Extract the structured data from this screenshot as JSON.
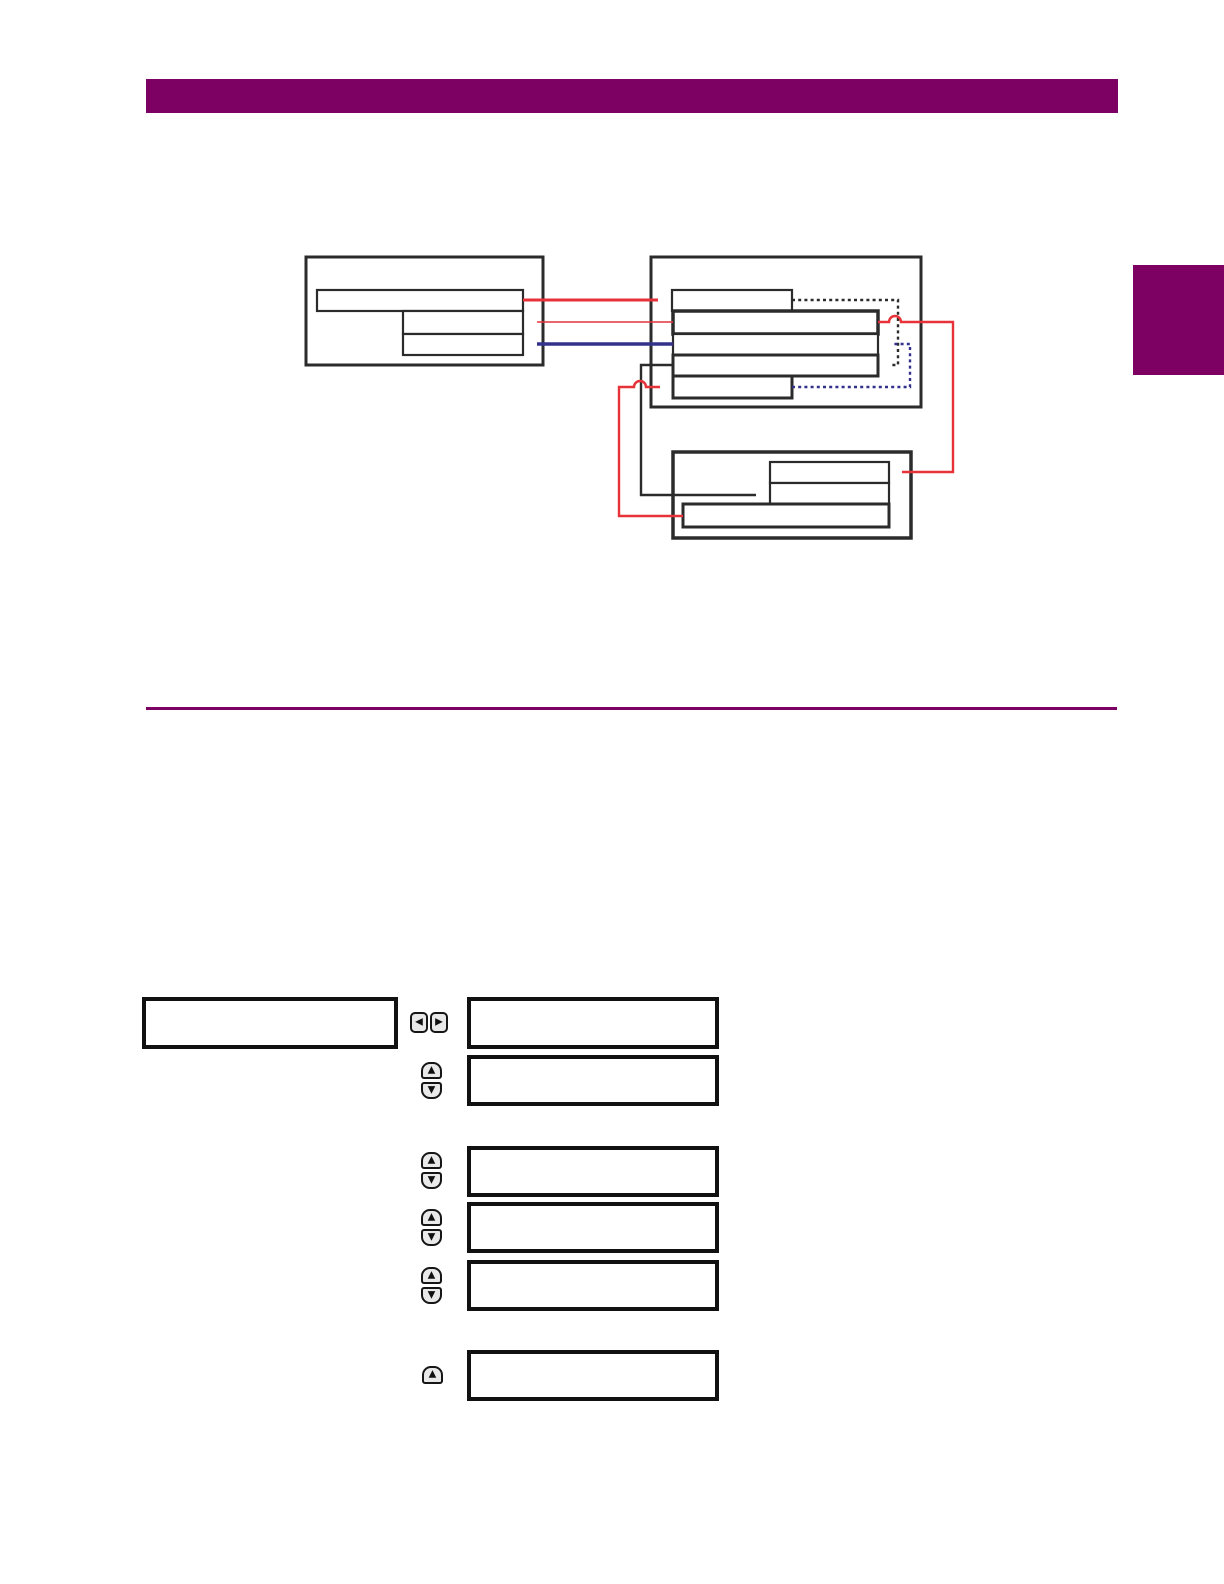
{
  "page": {
    "width_px": 1224,
    "height_px": 1584,
    "background": "#ffffff"
  },
  "theme": {
    "accent": "#7d0063",
    "line_black": "#2b2b2b",
    "line_red": "#e63238",
    "line_blue": "#32328c",
    "key_fill": "#e9e9e9",
    "key_border": "#161616",
    "lcd_border": "#111111"
  },
  "header": {
    "bar_color": "#7d0063",
    "text": ""
  },
  "side_tab": {
    "color": "#7d0063",
    "text": ""
  },
  "icons": {
    "left_arrow": "◀",
    "right_arrow": "▶",
    "up_arrow": "▲",
    "down_arrow": "▼"
  },
  "flow_diagram": {
    "left_group": {
      "rows": 3,
      "text": [
        "",
        "",
        ""
      ]
    },
    "right_group": {
      "rows": 5,
      "text": [
        "",
        "",
        "",
        "",
        ""
      ]
    },
    "bottom_group": {
      "rows": 3,
      "text": [
        "",
        "",
        ""
      ]
    },
    "arrows": [
      {
        "name": "red-solid-left-row1-to-right-row1",
        "color": "#e63238",
        "style": "solid"
      },
      {
        "name": "red-thin-right-row2-to-left-row2",
        "color": "#e63238",
        "style": "solid"
      },
      {
        "name": "blue-solid-right-row3-to-left-row3",
        "color": "#32328c",
        "style": "solid"
      },
      {
        "name": "black-dashed-right-row1-to-right-row4",
        "color": "#2b2b2b",
        "style": "dashed"
      },
      {
        "name": "blue-dashed-right-row5-to-right-row3",
        "color": "#32328c",
        "style": "dashed"
      },
      {
        "name": "red-route-right-row2-to-bottom-row1",
        "color": "#e63238",
        "style": "solid"
      },
      {
        "name": "black-route-right-row4-to-bottom-row2",
        "color": "#2b2b2b",
        "style": "solid"
      },
      {
        "name": "red-route-bottom-row3-to-right-row5",
        "color": "#e63238",
        "style": "solid"
      }
    ]
  },
  "keypad_figure": {
    "display_boxes": [
      {
        "id": "left-display",
        "text": ""
      },
      {
        "id": "right-display-1",
        "text": ""
      },
      {
        "id": "right-display-2",
        "text": ""
      },
      {
        "id": "right-display-3",
        "text": ""
      },
      {
        "id": "right-display-4",
        "text": ""
      },
      {
        "id": "right-display-5",
        "text": ""
      },
      {
        "id": "right-display-6",
        "text": ""
      }
    ],
    "key_groups": [
      {
        "type": "left-right-pair"
      },
      {
        "type": "up-down-pair"
      },
      {
        "type": "up-down-pair"
      },
      {
        "type": "up-down-pair"
      },
      {
        "type": "up-down-pair"
      },
      {
        "type": "up-single"
      }
    ]
  }
}
